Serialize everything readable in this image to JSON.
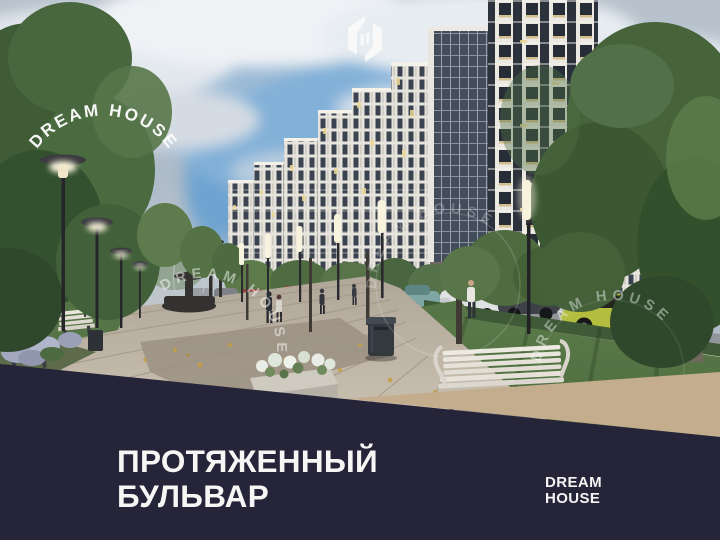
{
  "promo": {
    "title": {
      "line1": "ПРОТЯЖЕННЫЙ",
      "line2": "БУЛЬВАР"
    },
    "brand": {
      "line1": "DREAM",
      "line2": "HOUSE"
    },
    "watermark": {
      "arc_text": "DREAM HOUSE",
      "ring_text": "DREAM HOUSE"
    },
    "icons": {
      "emblem": "dream-house-monogram-icon"
    },
    "colors": {
      "footer_navy": "#252438",
      "wedge_tan": "#C4AD8C",
      "text_white": "#F6F6F5",
      "sky_blue": "#5F9ED2"
    }
  }
}
